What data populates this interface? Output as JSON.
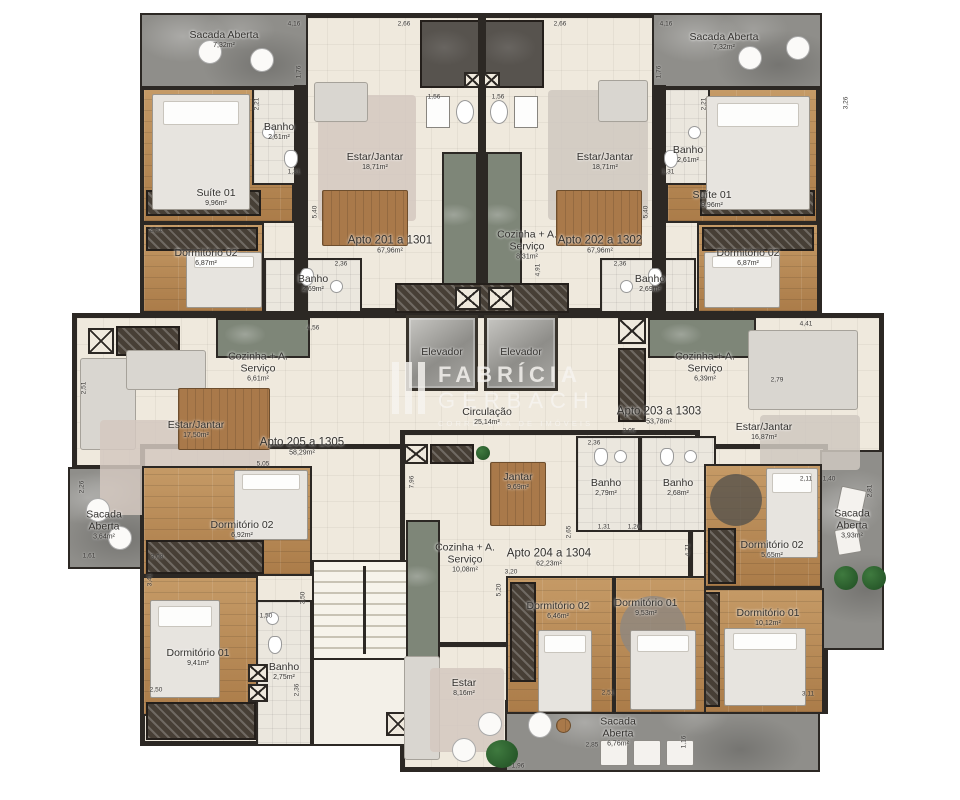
{
  "watermark": {
    "line1": "FABRÍCIA",
    "line2": "GERBACH",
    "line3": "CORRETORA DE IMÓVEIS"
  },
  "rooms": [
    {
      "name": "Sacada Aberta",
      "area": "7,32m²"
    },
    {
      "name": "Suíte 01",
      "area": "9,96m²"
    },
    {
      "name": "Banho",
      "area": "2,61m²"
    },
    {
      "name": "Dormitório 02",
      "area": "6,87m²"
    },
    {
      "name": "Banho",
      "area": "2,69m²"
    },
    {
      "name": "Estar/Jantar",
      "area": "18,71m²"
    },
    {
      "name": "Apto 201 a 1301",
      "area": "67,96m²"
    },
    {
      "name": "Cozinha + A. Serviço",
      "area": "8,31m²"
    },
    {
      "name": "Estar/Jantar",
      "area": "18,71m²"
    },
    {
      "name": "Apto 202 a 1302",
      "area": "67,96m²"
    },
    {
      "name": "Sacada Aberta",
      "area": "7,32m²"
    },
    {
      "name": "Banho",
      "area": "2,61m²"
    },
    {
      "name": "Suíte 01",
      "area": "9,96m²"
    },
    {
      "name": "Dormitório 02",
      "area": "6,87m²"
    },
    {
      "name": "Banho",
      "area": "2,69m²"
    },
    {
      "name": "Elevador"
    },
    {
      "name": "Elevador"
    },
    {
      "name": "Circulação",
      "area": "25,14m²"
    },
    {
      "name": "Cozinha + A. Serviço",
      "area": "6,61m²"
    },
    {
      "name": "Estar/Jantar",
      "area": "17,50m²"
    },
    {
      "name": "Apto 205 a 1305",
      "area": "58,29m²"
    },
    {
      "name": "Sacada Aberta",
      "area": "3,64m²"
    },
    {
      "name": "Dormitório 02",
      "area": "6,92m²"
    },
    {
      "name": "Dormitório 01",
      "area": "9,41m²"
    },
    {
      "name": "Banho",
      "area": "2,75m²"
    },
    {
      "name": "Cozinha + A. Serviço",
      "area": "6,39m²"
    },
    {
      "name": "Apto 203 a 1303",
      "area": "53,78m²"
    },
    {
      "name": "Estar/Jantar",
      "area": "16,87m²"
    },
    {
      "name": "Banho",
      "area": "2,79m²"
    },
    {
      "name": "Banho",
      "area": "2,68m²"
    },
    {
      "name": "Sacada Aberta",
      "area": "3,93m²"
    },
    {
      "name": "Dormitório 02",
      "area": "5,65m²"
    },
    {
      "name": "Dormitório 01",
      "area": "10,12m²"
    },
    {
      "name": "Jantar",
      "area": "9,69m²"
    },
    {
      "name": "Cozinha + A. Serviço",
      "area": "10,08m²"
    },
    {
      "name": "Apto 204 a 1304",
      "area": "62,23m²"
    },
    {
      "name": "Dormitório 02",
      "area": "6,46m²"
    },
    {
      "name": "Dormitório 01",
      "area": "9,53m²"
    },
    {
      "name": "Estar",
      "area": "8,16m²"
    },
    {
      "name": "Sacada Aberta",
      "area": "6,76m²"
    }
  ],
  "dims": [
    "4,16",
    "2,66",
    "2,66",
    "4,16",
    "1,76",
    "1,76",
    "2,21",
    "2,21",
    "1,31",
    "1,31",
    "5,40",
    "5,40",
    "3,26",
    "1,56",
    "1,56",
    "4,91",
    "2,91",
    "2,36",
    "2,36",
    "4,56",
    "2,51",
    "5,05",
    "2,05",
    "4,41",
    "2,79",
    "2,26",
    "1,61",
    "3,08",
    "3,41",
    "2,50",
    "1,50",
    "3,50",
    "2,36",
    "3,20",
    "5,20",
    "2,65",
    "2,36",
    "7,96",
    "1,31",
    "1,26",
    "2,11",
    "1,40",
    "2,81",
    "4,71",
    "3,11",
    "2,51",
    "1,96",
    "2,85",
    "1,16"
  ]
}
